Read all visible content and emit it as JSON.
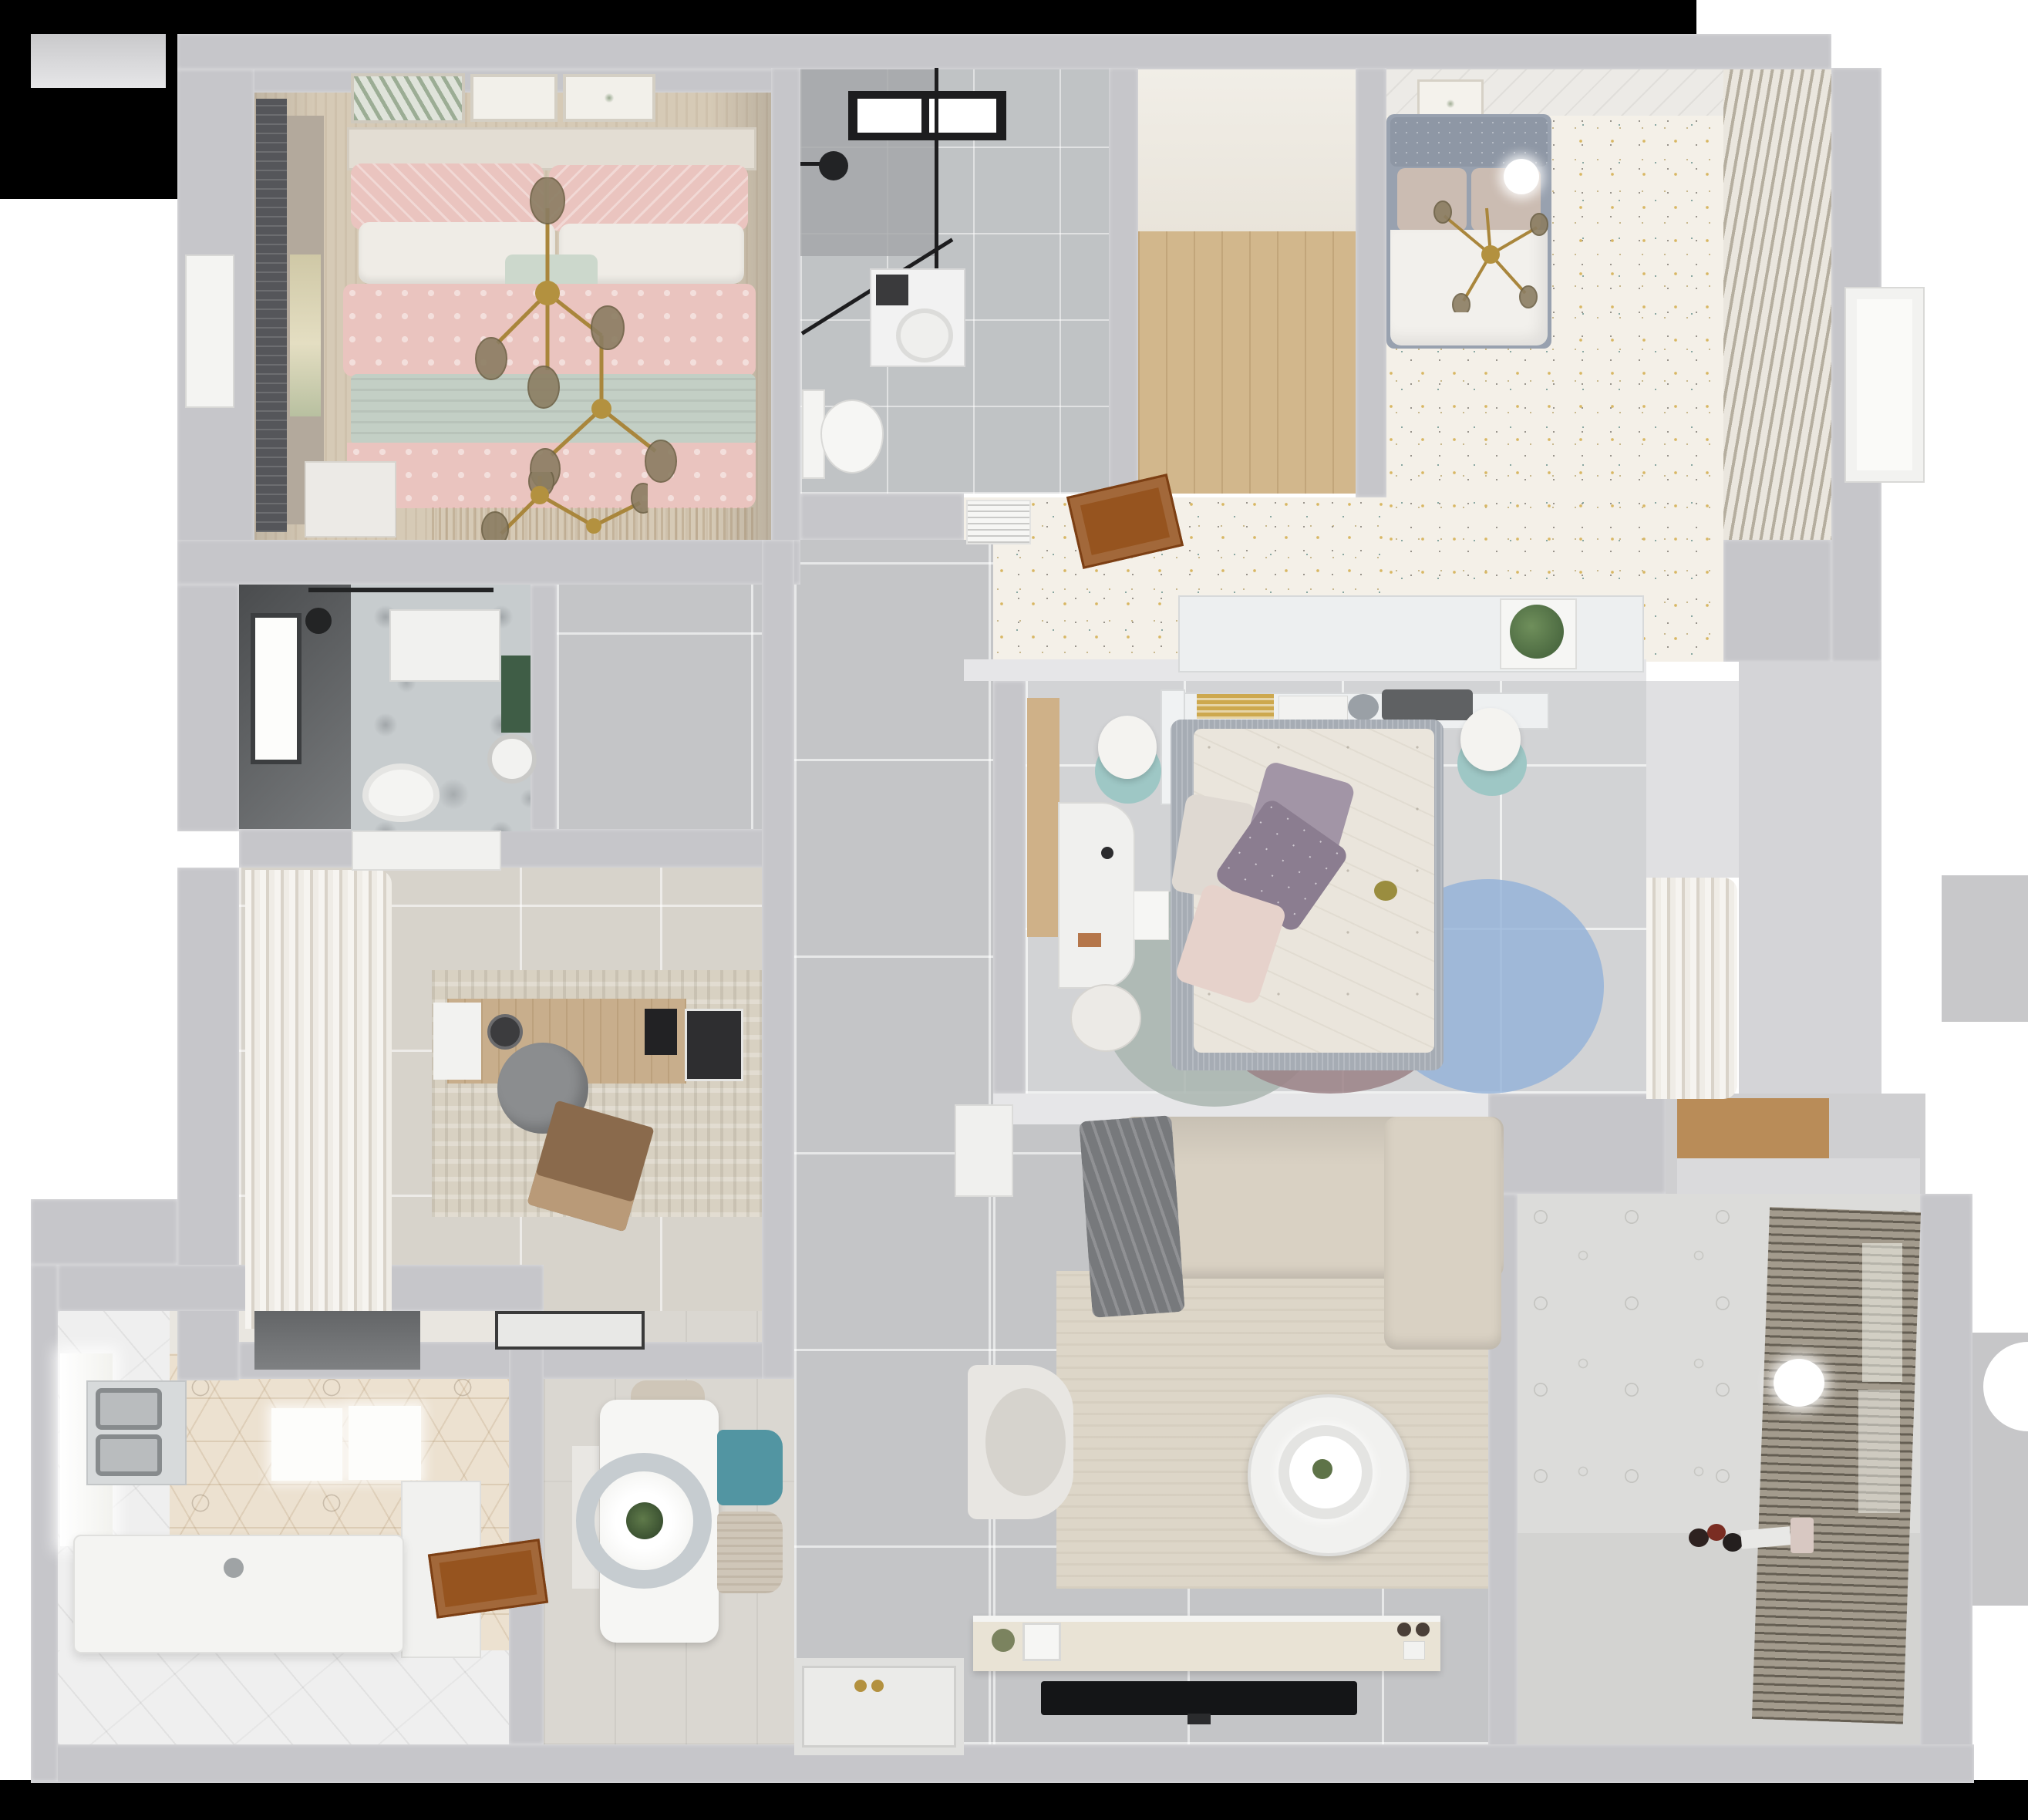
{
  "scene": {
    "title": "Top-down 3D dollhouse render of a two-bathroom apartment floor plan",
    "view": "orthographic top view, no text labels"
  },
  "palette": {
    "bg": "#ffffff",
    "black": "#000000",
    "wall": "#c6c6ca",
    "wall2": "#d4d4d7",
    "wallwhite": "#e6e6e8",
    "bm1floor": "#d6cab6",
    "blind": "#55565a",
    "tan": "#b3a99c",
    "pink": "#eac4bf",
    "sage": "#c3cfc5",
    "cream": "#efece6",
    "mint": "#ccd8cc",
    "headboard": "#e3ddd3",
    "gold": "#a9863c",
    "leaf": "#8b7d62",
    "bathAfloor": "#c0c3c5",
    "bathAdark": "#a2a5a7",
    "blackline": "#1d1d1f",
    "wood2": "#d2b78c",
    "glowtop": "#f1eee7",
    "speckle": "#f4f0e8",
    "sp1": "#d8b763",
    "sp2": "#8aa8a2",
    "sp3": "#9a958d",
    "bedframe2": "#98a1af",
    "tuft": "#8e97a5",
    "pillowtan": "#cbbcb2",
    "duvet": "#f2f0ec",
    "slat1": "#eae6de",
    "slat2": "#b5ae9f",
    "acwhite": "#f6f6f4",
    "doorbrown": "#96541f",
    "shelfwhite": "#edeff0",
    "plantgreen": "#4d6b42",
    "tile3": "#d2d3d5",
    "woodbench": "#cfb188",
    "deskwhite": "#f0f0ee",
    "lampteal": "#9ec7c5",
    "lampwhite": "#f4f3f0",
    "bed3frame": "#a6acb4",
    "duvet3": "#eae5dc",
    "purple": "#8b7d90",
    "purple2": "#a295a6",
    "blush": "#e6d2cb",
    "whitep": "#dfd9d2",
    "rugteal": "#a9b5af",
    "rugmauve": "#9b8186",
    "rugblue": "#92b2d8",
    "curtain1": "#f6f4f0",
    "curtain2": "#d9d3c9",
    "darkbath1": "#4a4c4e",
    "darkbath2": "#8f9294",
    "marble": "#c7ccce",
    "greenwall": "#3f5d46",
    "beigetile": "#d7d3cb",
    "rugstudy": "#d8d1c2",
    "deskwood": "#c8ae8c",
    "chairgray": "#8b8d8f",
    "laptop": "#8a6a4c",
    "matblack": "#3a3a3a",
    "hex1": "#ece1d0",
    "hood": "#6f7173",
    "steel": "#b9bcbe",
    "steeldark": "#878b8d",
    "islandwhite": "#f4f4f2",
    "whitetile": "#efefef",
    "plank": "#dad7d1",
    "tablewhite": "#f6f6f4",
    "ringgray": "#c6ccd0",
    "teal": "#5295a2",
    "chairbeige": "#cfc6b8",
    "sofa": "#d9d1c3",
    "blanket": "#77797c",
    "ruglive": "#ddd6c8",
    "tvblack": "#141517",
    "console": "#e9e3d5",
    "balwall": "#dcdcda",
    "balfloor": "#d3d3d1",
    "blindbase": "#a39b8d",
    "woodshelf": "#b98c58",
    "graytile": "#c4c5c7"
  },
  "rooms": [
    {
      "id": "bedroom-1",
      "name": "Bedroom 1 — pink bedding",
      "furniture": [
        "double bed",
        "pink patterned duvet",
        "sage throw blanket",
        "white and pink pillows",
        "gold branch chandelier",
        "nightstand",
        "dark roller blind window",
        "three wall art frames",
        "white door"
      ]
    },
    {
      "id": "bathroom-1",
      "name": "Bathroom 1 — walk-in shower",
      "furniture": [
        "black framed skylight",
        "black shower glass",
        "rain shower head",
        "washing machine",
        "wall-hung toilet"
      ]
    },
    {
      "id": "closet",
      "name": "Closet / pantry with wood floor",
      "furniture": [
        "light wood plank floor"
      ]
    },
    {
      "id": "bedroom-2",
      "name": "Bedroom 2 — white bed on terrazzo floor",
      "furniture": [
        "bed with gray tufted frame",
        "two beige pillows",
        "white duvet",
        "gold ceiling fan light",
        "framed botanical print",
        "louvered wardrobe"
      ]
    },
    {
      "id": "hallway-terrazzo",
      "name": "Hallway with speckled terrazzo floor",
      "furniture": [
        "white radiator grille",
        "open wooden door",
        "low white shelf with plant"
      ]
    },
    {
      "id": "bedroom-3",
      "name": "Bedroom 3 — floral duvet and circle rug",
      "furniture": [
        "upholstered bed",
        "purple and blush pillows",
        "headboard shelf with books",
        "two lamps on teal stools",
        "white desk with chair",
        "rug of overlapping circles",
        "sheer curtain wardrobe",
        "wood side bench"
      ]
    },
    {
      "id": "bathroom-2",
      "name": "Bathroom 2 — dark tiled",
      "furniture": [
        "window",
        "rain shower",
        "marble feature wall",
        "white poster frame",
        "toilet",
        "round basin",
        "green accent"
      ]
    },
    {
      "id": "study",
      "name": "Study / home office",
      "furniture": [
        "white wave curtains",
        "window sill",
        "wood desk",
        "papers and tablet",
        "gray office chair",
        "laptop",
        "textured area rug",
        "black door mat"
      ]
    },
    {
      "id": "kitchen",
      "name": "Kitchen — hexagon tile floor",
      "furniture": [
        "range hood",
        "double stainless sink",
        "lit counters",
        "white island with faucet",
        "side counter",
        "open wooden door",
        "white tile floor",
        "window"
      ]
    },
    {
      "id": "dining",
      "name": "Dining area",
      "furniture": [
        "white rectangular table",
        "ring pendant light with plant",
        "beige chair",
        "teal chair",
        "second beige chair",
        "white bench slab"
      ]
    },
    {
      "id": "living",
      "name": "Living room",
      "furniture": [
        "L-shaped beige sofa",
        "gray throw blanket",
        "round two-tier coffee table",
        "armchair",
        "side table",
        "TV console with decor",
        "wall-mounted TV",
        "large area rug"
      ]
    },
    {
      "id": "hallway-main",
      "name": "Main hallway and entry",
      "furniture": [
        "large gray floor tiles",
        "front door mat with gold handles"
      ]
    },
    {
      "id": "balcony",
      "name": "Balcony / laundry",
      "furniture": [
        "venetian blind wall",
        "white pendant ball light",
        "patterned tile wall",
        "toys on floor",
        "white mat"
      ]
    },
    {
      "id": "storage-niche",
      "name": "Storage niche with wood shelf",
      "furniture": [
        "wood shelf"
      ]
    }
  ]
}
